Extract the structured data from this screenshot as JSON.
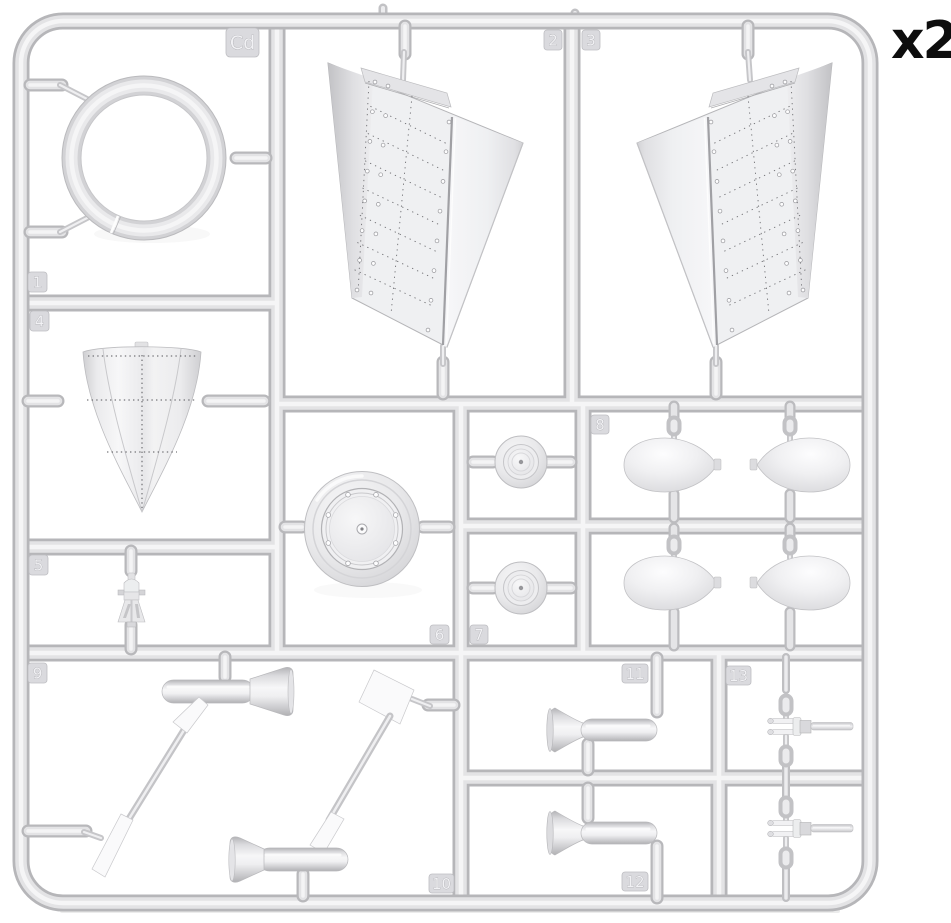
{
  "figure": {
    "sprue_code": "Cd",
    "quantity_label": "x2",
    "part_numbers": [
      "1",
      "2",
      "3",
      "4",
      "5",
      "6",
      "7",
      "8",
      "9",
      "10",
      "11",
      "12",
      "13"
    ],
    "colors": {
      "plastic_base": "#d9d9dc",
      "plastic_shadow": "#b6b6b9",
      "plastic_highlight": "#f5f5f6",
      "background": "#ffffff",
      "quantity_text": "#0d0d0d"
    }
  }
}
